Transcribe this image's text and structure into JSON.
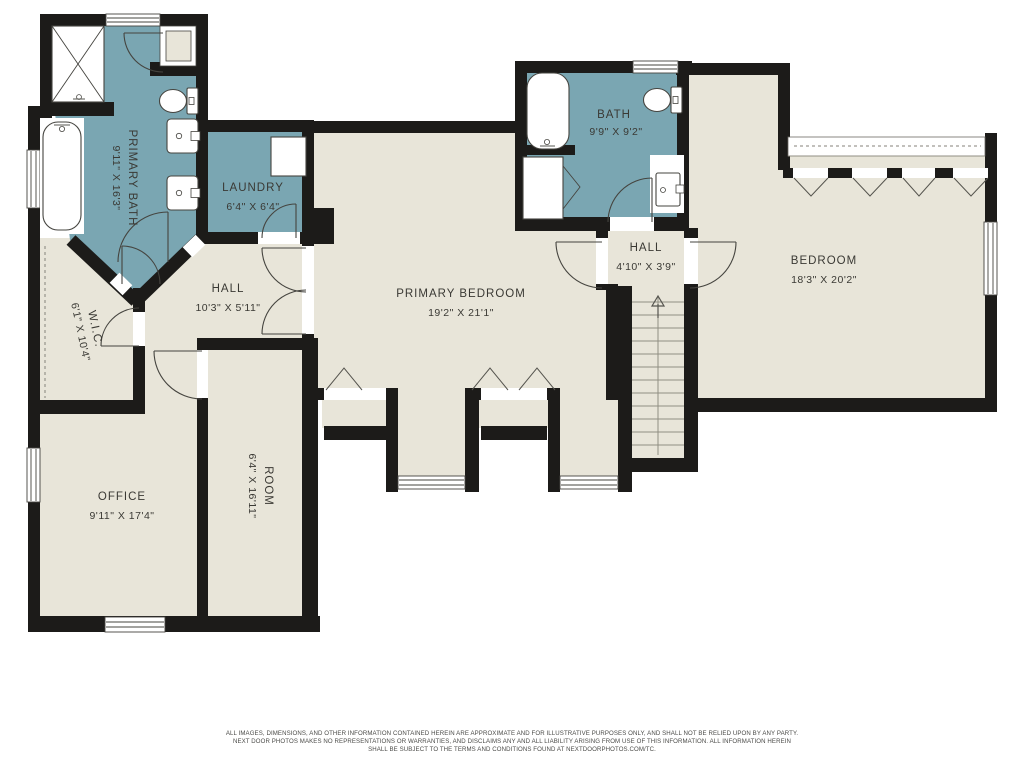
{
  "colors": {
    "floor": "#e8e5d9",
    "wet": "#7aa6b2",
    "wall": "#1c1b19",
    "line": "#45443f",
    "tread": "#908e83",
    "label": "#3a3934",
    "footer": "#4b4b48"
  },
  "rooms": [
    {
      "id": "primary-bath",
      "label": "PRIMARY BATH",
      "dims": "9'11\" X 16'3\""
    },
    {
      "id": "laundry",
      "label": "LAUNDRY",
      "dims": "6'4\" X 6'4\""
    },
    {
      "id": "wic",
      "label": "W.I.C.",
      "dims": "6'1\" X 10'4\""
    },
    {
      "id": "hall-upper",
      "label": "HALL",
      "dims": "10'3\" X 5'11\""
    },
    {
      "id": "primary-bedroom",
      "label": "PRIMARY BEDROOM",
      "dims": "19'2\" X 21'1\""
    },
    {
      "id": "bath",
      "label": "BATH",
      "dims": "9'9\" X 9'2\""
    },
    {
      "id": "hall-landing",
      "label": "HALL",
      "dims": "4'10\" X 3'9\""
    },
    {
      "id": "bedroom",
      "label": "BEDROOM",
      "dims": "18'3\" X 20'2\""
    },
    {
      "id": "office",
      "label": "OFFICE",
      "dims": "9'11\" X 17'4\""
    },
    {
      "id": "room",
      "label": "ROOM",
      "dims": "6'4\" X 16'11\""
    }
  ],
  "footer": {
    "line1": "ALL IMAGES, DIMENSIONS, AND OTHER INFORMATION CONTAINED HEREIN ARE APPROXIMATE AND FOR ILLUSTRATIVE PURPOSES ONLY, AND SHALL NOT BE RELIED UPON BY ANY PARTY.",
    "line2": "NEXT DOOR PHOTOS MAKES NO REPRESENTATIONS OR WARRANTIES, AND DISCLAIMS ANY AND ALL LIABILITY ARISING FROM USE OF THIS INFORMATION. ALL INFORMATION HEREIN",
    "line3": "SHALL BE SUBJECT TO THE TERMS AND CONDITIONS FOUND AT NEXTDOORPHOTOS.COM/TC."
  }
}
